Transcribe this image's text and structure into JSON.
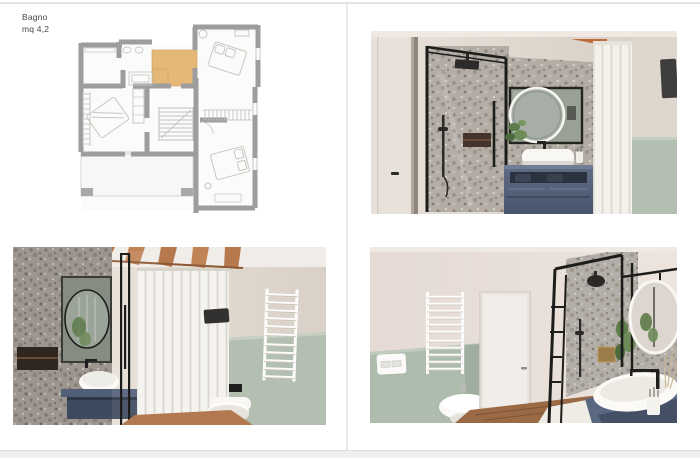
{
  "caption": {
    "title": "Bagno",
    "area": "mq 4,2"
  },
  "floor_plan": {
    "name": "first-floor-plan",
    "highlighted_room": "bagno",
    "colors": {
      "wall": "#9d9d9d",
      "room_fill": "#fafaf8",
      "highlight": "#e5b878",
      "furniture_line": "#c7c7c5"
    }
  },
  "photos": [
    {
      "name": "render-shower-mirror-vanity",
      "position": "top-right",
      "features": [
        "black framed glass shower",
        "terrazzo stone wall",
        "rectangular mirror with round led mirror",
        "white countertop basin",
        "blue-grey vanity",
        "white curtain",
        "sage green wainscot",
        "wall speaker"
      ]
    },
    {
      "name": "render-vanity-curtain-toilet",
      "position": "bottom-left",
      "features": [
        "terrazzo wall with niche",
        "round mirror",
        "vessel basin on blue vanity",
        "glass partition",
        "striped shower curtain",
        "wood ceiling beams",
        "wall hung toilet",
        "white towel radiator",
        "sage green wainscot"
      ]
    },
    {
      "name": "render-bidet-door-shower-basin",
      "position": "bottom-right",
      "features": [
        "white towel radiator",
        "flush plate",
        "bidet",
        "white door",
        "wood floor",
        "black framed shower with brass niche",
        "round mirror on black frame",
        "oval basin on blue vanity",
        "plant"
      ]
    }
  ],
  "palette": {
    "terrazzo": "#b3ada5",
    "terrazzo_dark": "#9a938b",
    "sage_green": "#b3bfb0",
    "beige_wall": "#ddd5cb",
    "pink_beige_wall": "#e3d9d3",
    "vanity_blue": "#515e78",
    "wood_beam": "#b5794d",
    "wood_floor": "#9a6a45",
    "black_frame": "#1d1d1b",
    "curtain_white": "#f3f1ec",
    "brass_niche": "#9a7d4a",
    "page_white": "#ffffff",
    "divider_grey": "#e7e7e7"
  }
}
